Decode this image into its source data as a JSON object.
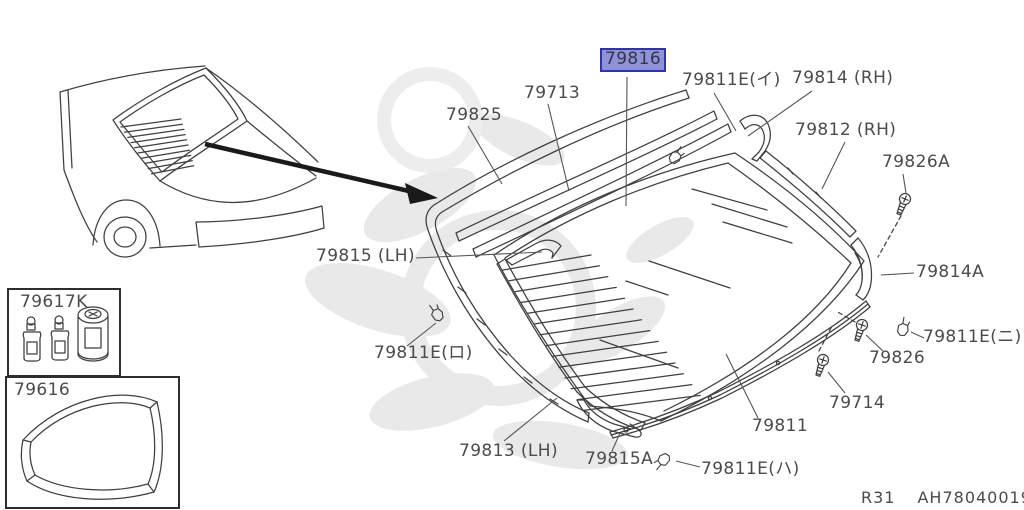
{
  "doc": {
    "type": "parts-diagram",
    "footer": {
      "sheet": "R31",
      "code": "AH78040019"
    }
  },
  "colors": {
    "line": "#3f3f3f",
    "label_text": "#4b4b4b",
    "highlight_fill": "#8f92d7",
    "highlight_border": "#2f35a6",
    "watermark": "#e9e9e9"
  },
  "icons": {
    "screw": "screw-icon",
    "clip": "clip-icon",
    "arrow": "callout-arrow-icon"
  },
  "diagram": {
    "labels": [
      {
        "text": "79825",
        "x": 446,
        "y": 106,
        "leader": [
          [
            468,
            126
          ],
          [
            502,
            184
          ]
        ]
      },
      {
        "text": "79713",
        "x": 524,
        "y": 84,
        "leader": [
          [
            548,
            104
          ],
          [
            569,
            191
          ]
        ]
      },
      {
        "text": "79816",
        "x": 602,
        "y": 50,
        "highlighted": true,
        "leader": [
          [
            627,
            77
          ],
          [
            626,
            206
          ]
        ]
      },
      {
        "text": "79811E(イ)",
        "x": 682,
        "y": 71,
        "leader": [
          [
            714,
            93
          ],
          [
            736,
            131
          ]
        ]
      },
      {
        "text": "79814 (RH)",
        "x": 792,
        "y": 69,
        "leader": [
          [
            812,
            91
          ],
          [
            748,
            136
          ]
        ]
      },
      {
        "text": "79812 (RH)",
        "x": 795,
        "y": 121,
        "leader": [
          [
            845,
            142
          ],
          [
            822,
            189
          ]
        ]
      },
      {
        "text": "79826A",
        "x": 882,
        "y": 153,
        "leader": [
          [
            903,
            174
          ],
          [
            906,
            193
          ]
        ]
      },
      {
        "text": "79814A",
        "x": 916,
        "y": 263,
        "leader": [
          [
            914,
            273
          ],
          [
            881,
            275
          ]
        ]
      },
      {
        "text": "79811E(ニ)",
        "x": 923,
        "y": 328,
        "leader": [
          [
            924,
            338
          ],
          [
            911,
            332
          ]
        ]
      },
      {
        "text": "79826",
        "x": 869,
        "y": 349,
        "leader": [
          [
            883,
            351
          ],
          [
            866,
            335
          ]
        ]
      },
      {
        "text": "79714",
        "x": 829,
        "y": 394,
        "leader": [
          [
            845,
            393
          ],
          [
            828,
            372
          ]
        ]
      },
      {
        "text": "79811",
        "x": 752,
        "y": 417,
        "leader": [
          [
            758,
            418
          ],
          [
            726,
            354
          ]
        ]
      },
      {
        "text": "79811E(ハ)",
        "x": 701,
        "y": 460,
        "leader": [
          [
            700,
            467
          ],
          [
            676,
            461
          ]
        ]
      },
      {
        "text": "79815A",
        "x": 585,
        "y": 450,
        "leader": [
          [
            612,
            451
          ],
          [
            620,
            433
          ]
        ]
      },
      {
        "text": "79813 (LH)",
        "x": 459,
        "y": 442,
        "leader": [
          [
            504,
            441
          ],
          [
            557,
            398
          ]
        ]
      },
      {
        "text": "79811E(ロ)",
        "x": 374,
        "y": 344,
        "leader": [
          [
            407,
            346
          ],
          [
            436,
            323
          ]
        ]
      },
      {
        "text": "79815 (LH)",
        "x": 316,
        "y": 247,
        "leader": [
          [
            416,
            258
          ],
          [
            542,
            252
          ]
        ]
      },
      {
        "text": "79617K",
        "x": 20,
        "y": 293,
        "inset": true
      },
      {
        "text": "79616",
        "x": 14,
        "y": 381,
        "inset": true
      }
    ]
  }
}
